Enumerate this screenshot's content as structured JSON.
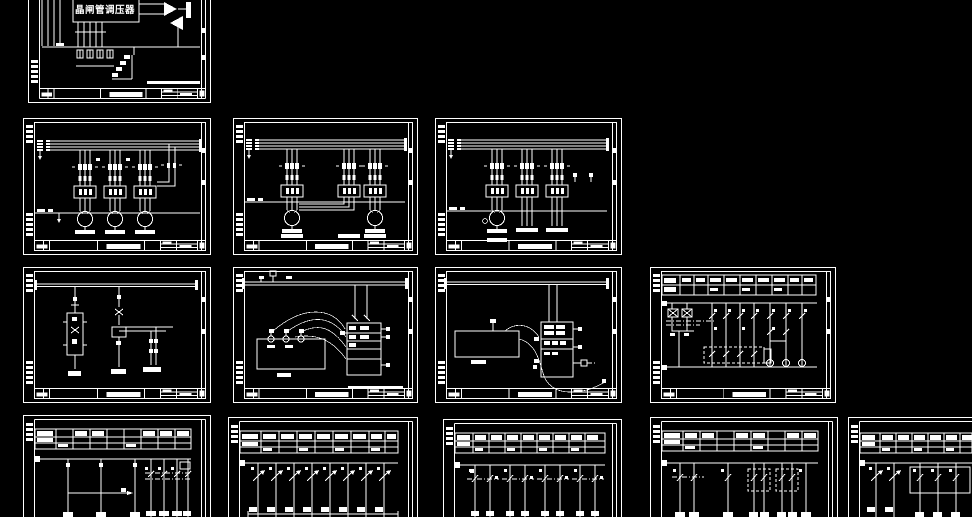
{
  "canvas": {
    "background": "#000000",
    "line_color": "#ffffff",
    "width": 972,
    "height": 517,
    "description_kind": "cad-model-space-black-canvas"
  },
  "drawing": {
    "regulator_label": "晶闸管调压器"
  },
  "sheets": [
    {
      "id": "r1c1",
      "kind": "thyristor-regulator-schematic",
      "partially_visible": true
    },
    {
      "id": "r2c1",
      "kind": "motor-power-schematic-three-motors"
    },
    {
      "id": "r2c2",
      "kind": "motor-power-schematic-two-motors"
    },
    {
      "id": "r2c3",
      "kind": "motor-power-schematic-one-motor"
    },
    {
      "id": "r3c1",
      "kind": "control-schematic"
    },
    {
      "id": "r3c2",
      "kind": "wiring-connection-diagram"
    },
    {
      "id": "r3c3",
      "kind": "wiring-connection-diagram"
    },
    {
      "id": "r3c4",
      "kind": "relay-ladder-with-table"
    },
    {
      "id": "r4c1",
      "kind": "feeder-distribution-schematic",
      "partially_visible": true
    },
    {
      "id": "r4c2",
      "kind": "feeder-distribution-schematic",
      "partially_visible": true
    },
    {
      "id": "r4c3",
      "kind": "feeder-distribution-schematic",
      "partially_visible": true
    },
    {
      "id": "r4c4",
      "kind": "feeder-distribution-schematic",
      "partially_visible": true
    },
    {
      "id": "r4c5",
      "kind": "feeder-distribution-schematic",
      "partially_visible": true
    }
  ]
}
